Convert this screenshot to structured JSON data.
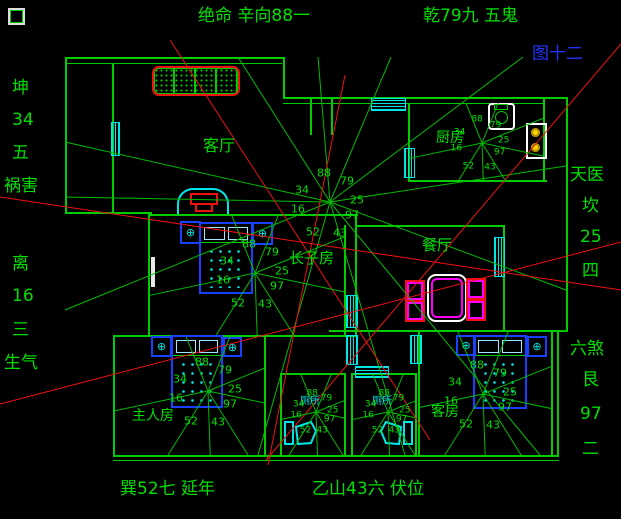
{
  "figure_label": "图十二",
  "annotations": {
    "top_left": "绝命 辛向88一",
    "top_right": "乾79九 五鬼",
    "bottom_left": "巽52七 延年",
    "bottom_right": "乙山43六 伏位",
    "left_upper": [
      "坤",
      "34",
      "五",
      "祸害"
    ],
    "left_lower": [
      "离",
      "16",
      "三",
      "生气"
    ],
    "right_upper": [
      "天医",
      "坎",
      "25",
      "四"
    ],
    "right_lower": [
      "六煞",
      "艮",
      "97",
      "二"
    ]
  },
  "rooms": {
    "living": "客厅",
    "kitchen": "厨房",
    "dining": "餐厅",
    "eldest_son": "长子房",
    "master": "主人房",
    "guest": "客房",
    "bathroom_left": "厕所",
    "bathroom_right": "厕所"
  },
  "star_numbers": [
    "88",
    "79",
    "34",
    "25",
    "16",
    "97",
    "43",
    "52"
  ],
  "colors": {
    "background": "#000000",
    "line_green": "#00bb00",
    "text_green": "#00e000",
    "cyan": "#00e6e6",
    "red": "#ee1111",
    "blue_label": "#2233ff",
    "bed_blue": "#1840ff",
    "magenta": "#ff00ff",
    "yellow": "#ffd400",
    "white": "#ffffff"
  },
  "floorplan": {
    "walls": [
      [
        65,
        57,
        220,
        2
      ],
      [
        65,
        63,
        217,
        1
      ],
      [
        65,
        57,
        2,
        157
      ],
      [
        283,
        57,
        2,
        42
      ],
      [
        283,
        97,
        285,
        2
      ],
      [
        283,
        103,
        262,
        1
      ],
      [
        566,
        97,
        2,
        235
      ],
      [
        112,
        63,
        2,
        151
      ],
      [
        65,
        212,
        87,
        2
      ],
      [
        148,
        214,
        2,
        123
      ],
      [
        150,
        214,
        208,
        2
      ],
      [
        344,
        225,
        2,
        112
      ],
      [
        355,
        214,
        2,
        123
      ],
      [
        113,
        335,
        245,
        2
      ],
      [
        113,
        335,
        2,
        122
      ],
      [
        113,
        455,
        446,
        2
      ],
      [
        113,
        460,
        446,
        1
      ],
      [
        264,
        337,
        2,
        118
      ],
      [
        280,
        373,
        66,
        2
      ],
      [
        280,
        373,
        2,
        82
      ],
      [
        344,
        373,
        2,
        82
      ],
      [
        351,
        373,
        66,
        2
      ],
      [
        351,
        373,
        2,
        82
      ],
      [
        415,
        373,
        2,
        82
      ],
      [
        329,
        330,
        230,
        2
      ],
      [
        418,
        332,
        2,
        123
      ],
      [
        551,
        332,
        2,
        123
      ],
      [
        557,
        330,
        11,
        2
      ],
      [
        408,
        103,
        2,
        79
      ],
      [
        408,
        180,
        139,
        2
      ],
      [
        543,
        97,
        2,
        85
      ],
      [
        310,
        97,
        2,
        38
      ],
      [
        331,
        97,
        2,
        38
      ],
      [
        355,
        225,
        150,
        2
      ],
      [
        503,
        225,
        2,
        107
      ],
      [
        557,
        332,
        2,
        123
      ]
    ],
    "windows": [
      [
        371,
        98,
        33,
        11,
        "h"
      ],
      [
        111,
        122,
        7,
        32,
        "v"
      ],
      [
        404,
        148,
        9,
        28,
        "v"
      ],
      [
        494,
        237,
        9,
        38,
        "v"
      ],
      [
        346,
        295,
        10,
        31,
        "v"
      ],
      [
        346,
        335,
        10,
        28,
        "v"
      ],
      [
        410,
        335,
        10,
        27,
        "v"
      ],
      [
        355,
        366,
        32,
        10,
        "h"
      ]
    ],
    "main_star": {
      "cx": 330,
      "cy": 202,
      "rays": [
        [
          65,
          142
        ],
        [
          65,
          197
        ],
        [
          65,
          310
        ],
        [
          238,
          57
        ],
        [
          318,
          57
        ],
        [
          391,
          57
        ],
        [
          523,
          57
        ],
        [
          566,
          166
        ],
        [
          566,
          290
        ],
        [
          540,
          455
        ],
        [
          405,
          455
        ],
        [
          258,
          455
        ]
      ]
    },
    "room_stars": [
      {
        "room": "kitchen",
        "cx": 482,
        "cy": 143,
        "scale": 0.8,
        "bounds": [
          410,
          103,
          543,
          180
        ]
      },
      {
        "room": "eldest_son",
        "cx": 255,
        "cy": 273,
        "scale": 1,
        "bounds": [
          150,
          216,
          344,
          335
        ]
      },
      {
        "room": "master",
        "cx": 208,
        "cy": 391,
        "scale": 1,
        "bounds": [
          115,
          337,
          264,
          455
        ]
      },
      {
        "room": "guest",
        "cx": 483,
        "cy": 394,
        "scale": 1,
        "bounds": [
          420,
          332,
          551,
          455
        ]
      },
      {
        "room": "bathroom_left",
        "cx": 316,
        "cy": 412,
        "scale": 0.62,
        "bounds": [
          282,
          375,
          344,
          455
        ]
      },
      {
        "room": "bathroom_right",
        "cx": 388,
        "cy": 412,
        "scale": 0.62,
        "bounds": [
          353,
          375,
          415,
          455
        ]
      }
    ],
    "red_lines": [
      [
        170,
        40,
        430,
        440
      ],
      [
        345,
        75,
        268,
        465
      ],
      [
        0,
        197,
        621,
        290
      ],
      [
        0,
        404,
        621,
        242
      ],
      [
        621,
        44,
        266,
        460
      ]
    ]
  }
}
